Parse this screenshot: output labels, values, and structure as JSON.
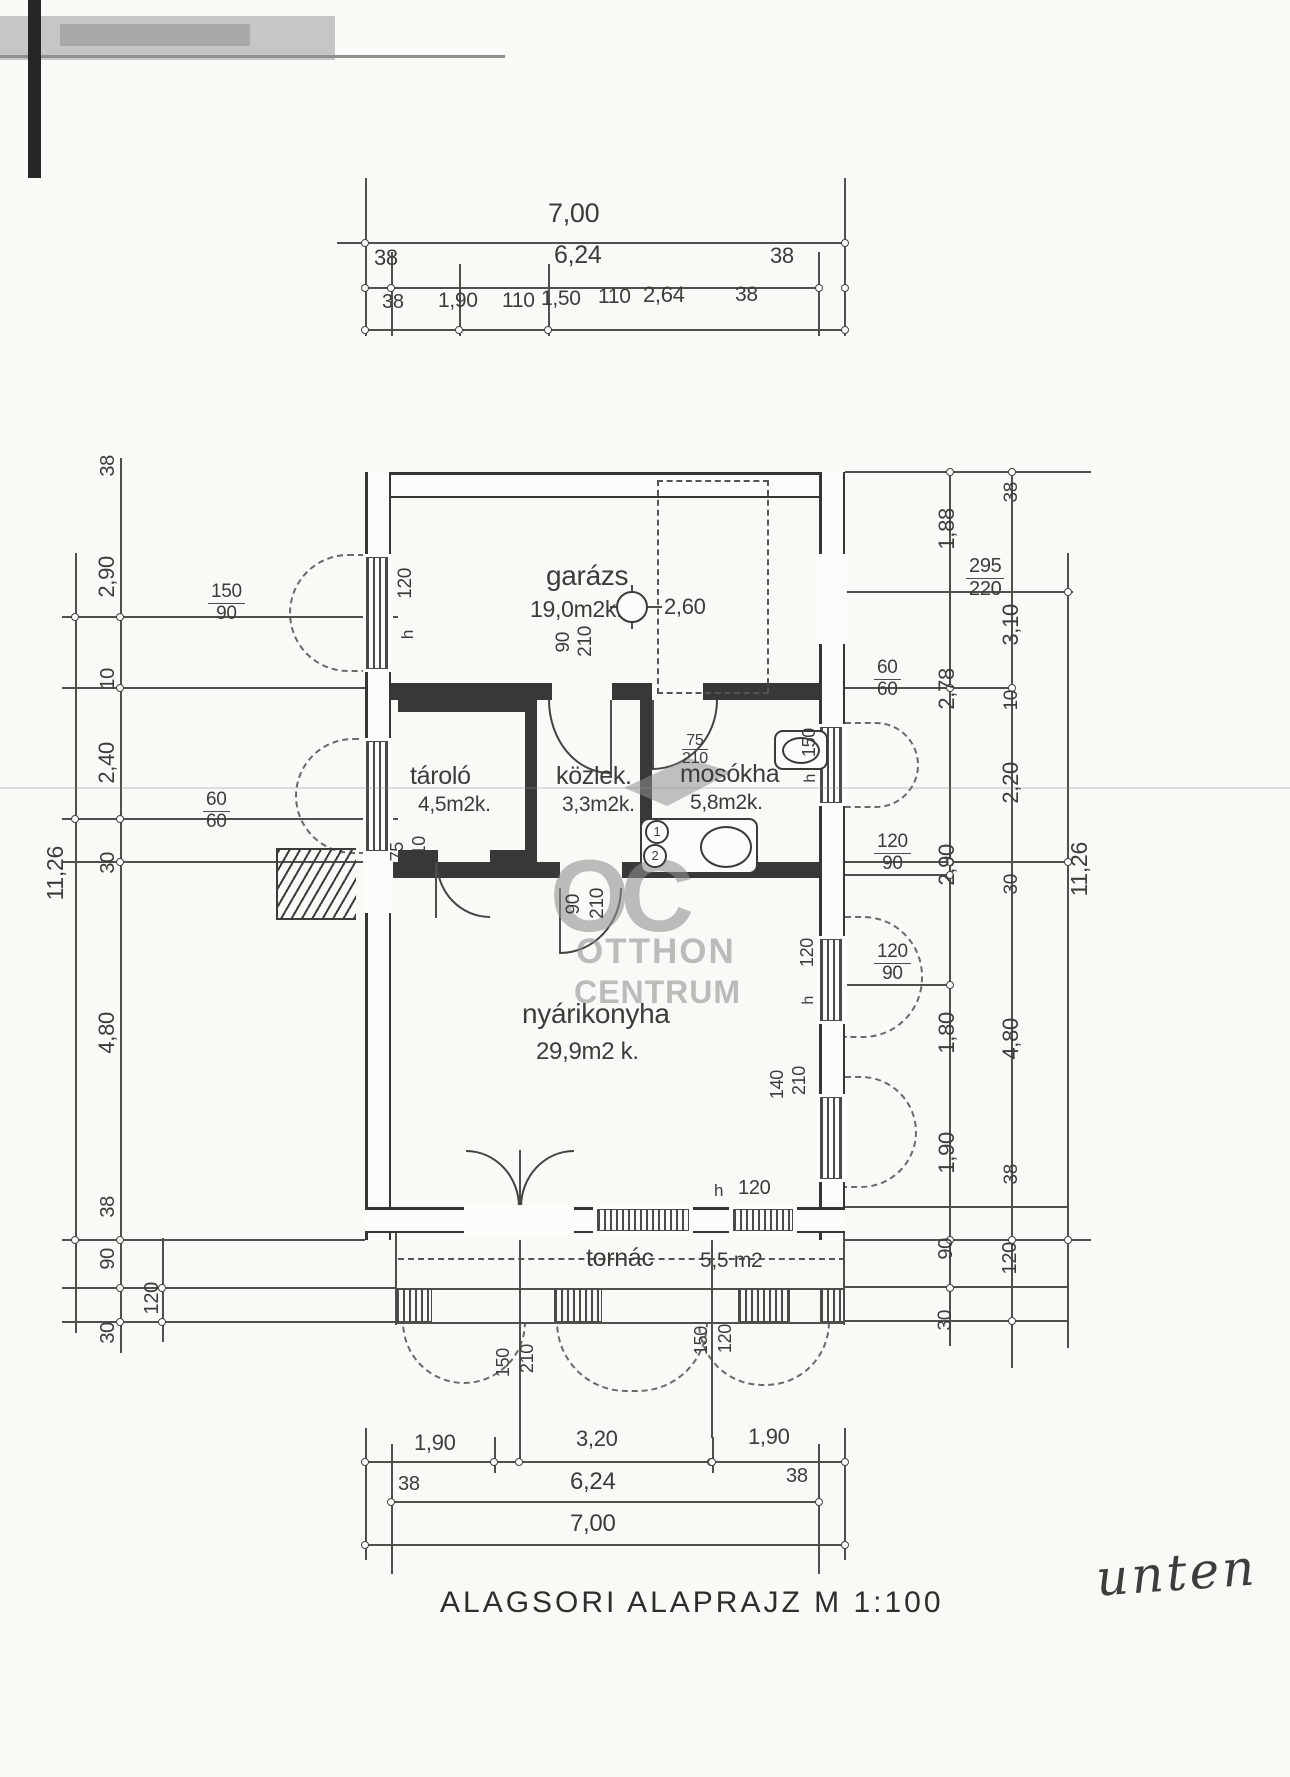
{
  "document": {
    "caption": "ALAGSORI ALAPRAJZ  M 1:100",
    "handwritten_note": "unten",
    "watermark": {
      "monogram": "OC",
      "line1": "OTTHON",
      "line2": "CENTRUM"
    }
  },
  "rooms": [
    {
      "name": "garázs",
      "area": "19,0m2k.",
      "height_mark": "2,60"
    },
    {
      "name": "tároló",
      "area": "4,5m2k."
    },
    {
      "name": "közlek.",
      "area": "3,3m2k."
    },
    {
      "name": "mosókha",
      "area": "5,8m2k."
    },
    {
      "name": "nyárikonyha",
      "area": "29,9m2 k."
    },
    {
      "name": "tornác",
      "area": "5,5 m2"
    }
  ],
  "labels": [
    {
      "t": "7,00",
      "x": 548,
      "y": 200,
      "fs": 27,
      "n": "dim-top-overall"
    },
    {
      "t": "38",
      "x": 374,
      "y": 247,
      "fs": 22
    },
    {
      "t": "6,24",
      "x": 554,
      "y": 243,
      "fs": 25
    },
    {
      "t": "38",
      "x": 770,
      "y": 245,
      "fs": 22
    },
    {
      "t": "38",
      "x": 382,
      "y": 292,
      "fs": 20
    },
    {
      "t": "1,90",
      "x": 438,
      "y": 290,
      "fs": 21
    },
    {
      "t": "110",
      "x": 502,
      "y": 290,
      "fs": 21
    },
    {
      "t": "1,50",
      "x": 541,
      "y": 288,
      "fs": 21
    },
    {
      "t": "110",
      "x": 598,
      "y": 286,
      "fs": 21
    },
    {
      "t": "2,64",
      "x": 643,
      "y": 284,
      "fs": 22
    },
    {
      "t": "38",
      "x": 735,
      "y": 284,
      "fs": 21
    },
    {
      "t": "38",
      "x": 98,
      "y": 455,
      "v": 1,
      "fs": 20
    },
    {
      "t": "2,90",
      "x": 96,
      "y": 556,
      "v": 1,
      "fs": 22
    },
    {
      "t": "10",
      "x": 98,
      "y": 668,
      "v": 1,
      "fs": 20
    },
    {
      "t": "2,40",
      "x": 96,
      "y": 742,
      "v": 1,
      "fs": 22
    },
    {
      "t": "30",
      "x": 98,
      "y": 852,
      "v": 1,
      "fs": 20
    },
    {
      "t": "4,80",
      "x": 96,
      "y": 1012,
      "v": 1,
      "fs": 22
    },
    {
      "t": "38",
      "x": 98,
      "y": 1196,
      "v": 1,
      "fs": 20
    },
    {
      "t": "90",
      "x": 98,
      "y": 1248,
      "v": 1,
      "fs": 20
    },
    {
      "t": "30",
      "x": 98,
      "y": 1322,
      "v": 1,
      "fs": 20
    },
    {
      "t": "120",
      "x": 142,
      "y": 1282,
      "v": 1,
      "fs": 20
    },
    {
      "t": "11,26",
      "x": 44,
      "y": 846,
      "v": 1,
      "fs": 23,
      "n": "dim-left-overall"
    },
    {
      "f": [
        "150",
        "90"
      ],
      "x": 208,
      "y": 582,
      "fs": 19
    },
    {
      "f": [
        "60",
        "60"
      ],
      "x": 203,
      "y": 790,
      "fs": 19
    },
    {
      "t": "75",
      "x": 388,
      "y": 842,
      "v": 1,
      "fs": 18
    },
    {
      "t": "210",
      "x": 410,
      "y": 836,
      "v": 1,
      "fs": 18
    },
    {
      "t": "120",
      "x": 396,
      "y": 568,
      "v": 1,
      "fs": 19
    },
    {
      "t": "h",
      "x": 399,
      "y": 630,
      "v": 1,
      "fs": 17
    },
    {
      "t": "1,88",
      "x": 936,
      "y": 508,
      "v": 1,
      "fs": 22
    },
    {
      "t": "38",
      "x": 1002,
      "y": 482,
      "v": 1,
      "fs": 19
    },
    {
      "t": "3,10",
      "x": 1000,
      "y": 604,
      "v": 1,
      "fs": 22
    },
    {
      "t": "2,78",
      "x": 936,
      "y": 668,
      "v": 1,
      "fs": 22
    },
    {
      "t": "10",
      "x": 1002,
      "y": 690,
      "v": 1,
      "fs": 19
    },
    {
      "t": "2,20",
      "x": 1000,
      "y": 762,
      "v": 1,
      "fs": 22
    },
    {
      "t": "2,90",
      "x": 936,
      "y": 844,
      "v": 1,
      "fs": 22
    },
    {
      "t": "30",
      "x": 1002,
      "y": 874,
      "v": 1,
      "fs": 19
    },
    {
      "t": "11,26",
      "x": 1068,
      "y": 842,
      "v": 1,
      "fs": 23,
      "n": "dim-right-overall"
    },
    {
      "t": "1,80",
      "x": 936,
      "y": 1012,
      "v": 1,
      "fs": 22
    },
    {
      "t": "4,80",
      "x": 1000,
      "y": 1018,
      "v": 1,
      "fs": 22
    },
    {
      "t": "1,90",
      "x": 936,
      "y": 1132,
      "v": 1,
      "fs": 22
    },
    {
      "t": "38",
      "x": 1002,
      "y": 1164,
      "v": 1,
      "fs": 19
    },
    {
      "t": "90",
      "x": 936,
      "y": 1238,
      "v": 1,
      "fs": 20
    },
    {
      "t": "120",
      "x": 1000,
      "y": 1242,
      "v": 1,
      "fs": 20
    },
    {
      "t": "30",
      "x": 936,
      "y": 1310,
      "v": 1,
      "fs": 19
    },
    {
      "f": [
        "295",
        "220"
      ],
      "x": 966,
      "y": 556,
      "fs": 20
    },
    {
      "f": [
        "60",
        "60"
      ],
      "x": 874,
      "y": 658,
      "fs": 19
    },
    {
      "f": [
        "120",
        "90"
      ],
      "x": 874,
      "y": 832,
      "fs": 19
    },
    {
      "f": [
        "120",
        "90"
      ],
      "x": 874,
      "y": 942,
      "fs": 19
    },
    {
      "t": "150",
      "x": 800,
      "y": 728,
      "v": 1,
      "fs": 18
    },
    {
      "t": "h",
      "x": 803,
      "y": 774,
      "v": 1,
      "fs": 16
    },
    {
      "t": "120",
      "x": 798,
      "y": 938,
      "v": 1,
      "fs": 18
    },
    {
      "t": "h",
      "x": 801,
      "y": 996,
      "v": 1,
      "fs": 16
    },
    {
      "t": "140",
      "x": 768,
      "y": 1070,
      "v": 1,
      "fs": 18
    },
    {
      "t": "210",
      "x": 790,
      "y": 1066,
      "v": 1,
      "fs": 18
    },
    {
      "t": "garázs",
      "x": 546,
      "y": 562,
      "fs": 28,
      "n": "room-name-garazs"
    },
    {
      "t": "19,0m2k.",
      "x": 530,
      "y": 598,
      "fs": 23,
      "n": "room-area-garazs"
    },
    {
      "t": "2,60",
      "x": 664,
      "y": 596,
      "fs": 22,
      "n": "height-mark-value"
    },
    {
      "t": "tároló",
      "x": 410,
      "y": 764,
      "fs": 25,
      "n": "room-name-tarolo"
    },
    {
      "t": "4,5m2k.",
      "x": 418,
      "y": 794,
      "fs": 21,
      "n": "room-area-tarolo"
    },
    {
      "t": "közlek.",
      "x": 556,
      "y": 764,
      "fs": 25,
      "n": "room-name-kozlek"
    },
    {
      "t": "3,3m2k.",
      "x": 562,
      "y": 794,
      "fs": 21,
      "n": "room-area-kozlek"
    },
    {
      "t": "mosókha",
      "x": 680,
      "y": 762,
      "fs": 25,
      "n": "room-name-mosokha"
    },
    {
      "t": "5,8m2k.",
      "x": 690,
      "y": 792,
      "fs": 21,
      "n": "room-area-mosokha"
    },
    {
      "t": "nyárikonyha",
      "x": 522,
      "y": 1000,
      "fs": 28,
      "n": "room-name-nyarikonyha"
    },
    {
      "t": "29,9m2 k.",
      "x": 536,
      "y": 1040,
      "fs": 24,
      "n": "room-area-nyarikonyha"
    },
    {
      "t": "tornác",
      "x": 586,
      "y": 1246,
      "fs": 25,
      "n": "room-name-tornac"
    },
    {
      "t": "5,5 m2",
      "x": 700,
      "y": 1250,
      "fs": 21,
      "n": "room-area-tornac"
    },
    {
      "f": [
        "75",
        "210"
      ],
      "x": 682,
      "y": 732,
      "fs": 16
    },
    {
      "t": "90",
      "x": 554,
      "y": 632,
      "v": 1,
      "fs": 19
    },
    {
      "t": "210",
      "x": 576,
      "y": 626,
      "v": 1,
      "fs": 19
    },
    {
      "t": "90",
      "x": 564,
      "y": 894,
      "v": 1,
      "fs": 19
    },
    {
      "t": "210",
      "x": 588,
      "y": 888,
      "v": 1,
      "fs": 19
    },
    {
      "t": "h",
      "x": 714,
      "y": 1182,
      "fs": 17
    },
    {
      "t": "120",
      "x": 738,
      "y": 1178,
      "fs": 20
    },
    {
      "t": "150",
      "x": 494,
      "y": 1348,
      "v": 1,
      "fs": 18
    },
    {
      "t": "210",
      "x": 518,
      "y": 1344,
      "v": 1,
      "fs": 18
    },
    {
      "t": "150",
      "x": 692,
      "y": 1326,
      "v": 1,
      "fs": 18
    },
    {
      "t": "120",
      "x": 716,
      "y": 1324,
      "v": 1,
      "fs": 18
    },
    {
      "t": "1",
      "x": 645,
      "y": 820,
      "c": 1,
      "fs": 13,
      "n": "fixture-mark-1"
    },
    {
      "t": "2",
      "x": 643,
      "y": 844,
      "c": 1,
      "fs": 13,
      "n": "fixture-mark-2"
    },
    {
      "t": "1,90",
      "x": 414,
      "y": 1432,
      "fs": 22
    },
    {
      "t": "3,20",
      "x": 576,
      "y": 1428,
      "fs": 22
    },
    {
      "t": "1,90",
      "x": 748,
      "y": 1426,
      "fs": 22
    },
    {
      "t": "38",
      "x": 398,
      "y": 1474,
      "fs": 20
    },
    {
      "t": "6,24",
      "x": 570,
      "y": 1470,
      "fs": 24
    },
    {
      "t": "38",
      "x": 786,
      "y": 1466,
      "fs": 20
    },
    {
      "t": "7,00",
      "x": 570,
      "y": 1512,
      "fs": 24,
      "n": "dim-bottom-overall"
    }
  ]
}
